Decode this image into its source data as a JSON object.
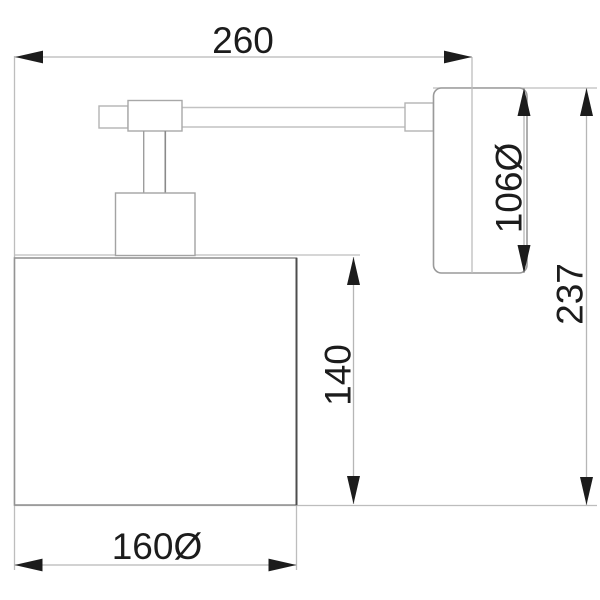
{
  "drawing": {
    "description": "wall-lamp-technical-drawing",
    "dimensions": {
      "arm_projection": "260",
      "backplate_diameter": "106Ø",
      "total_height": "237",
      "shade_height": "140",
      "shade_diameter": "160Ø"
    },
    "colors": {
      "background": "#ffffff",
      "text_and_arrows": "#1c1c1c",
      "object_lines": "#9a9a9a",
      "shade_dark_edge": "#4d4d4d",
      "dimension_lines": "#b6b6b6"
    }
  }
}
